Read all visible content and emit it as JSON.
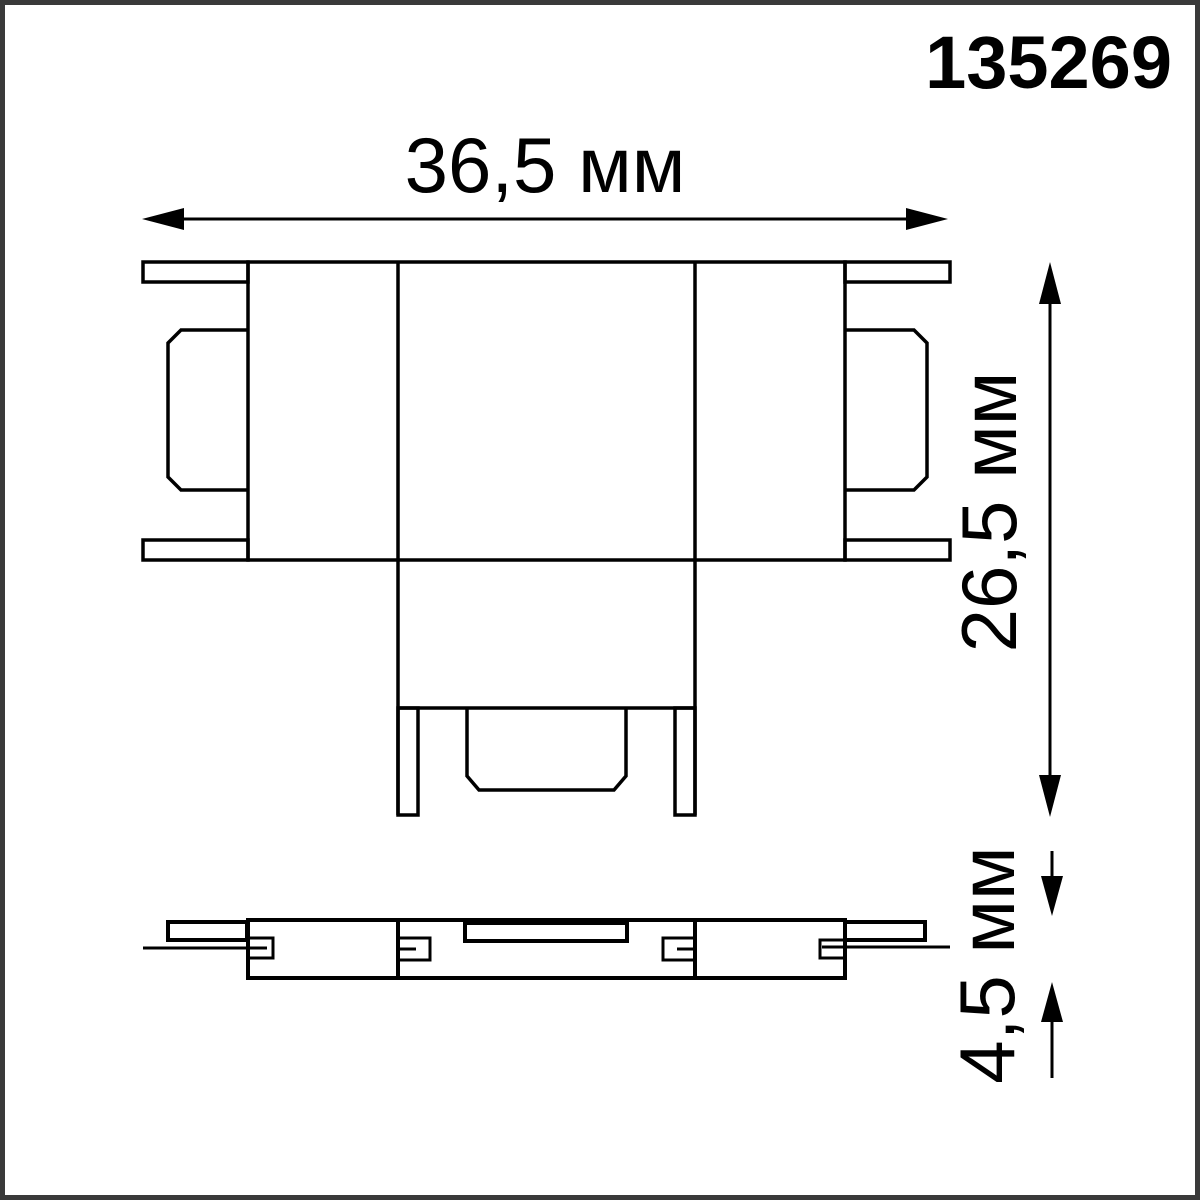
{
  "drawing": {
    "product_code": "135269",
    "dimensions": {
      "width": "36,5 мм",
      "height": "26,5 мм",
      "thickness": "4,5 мм"
    },
    "colors": {
      "line": "#000000",
      "frame": "#3a3a3a",
      "background": "#ffffff"
    }
  }
}
